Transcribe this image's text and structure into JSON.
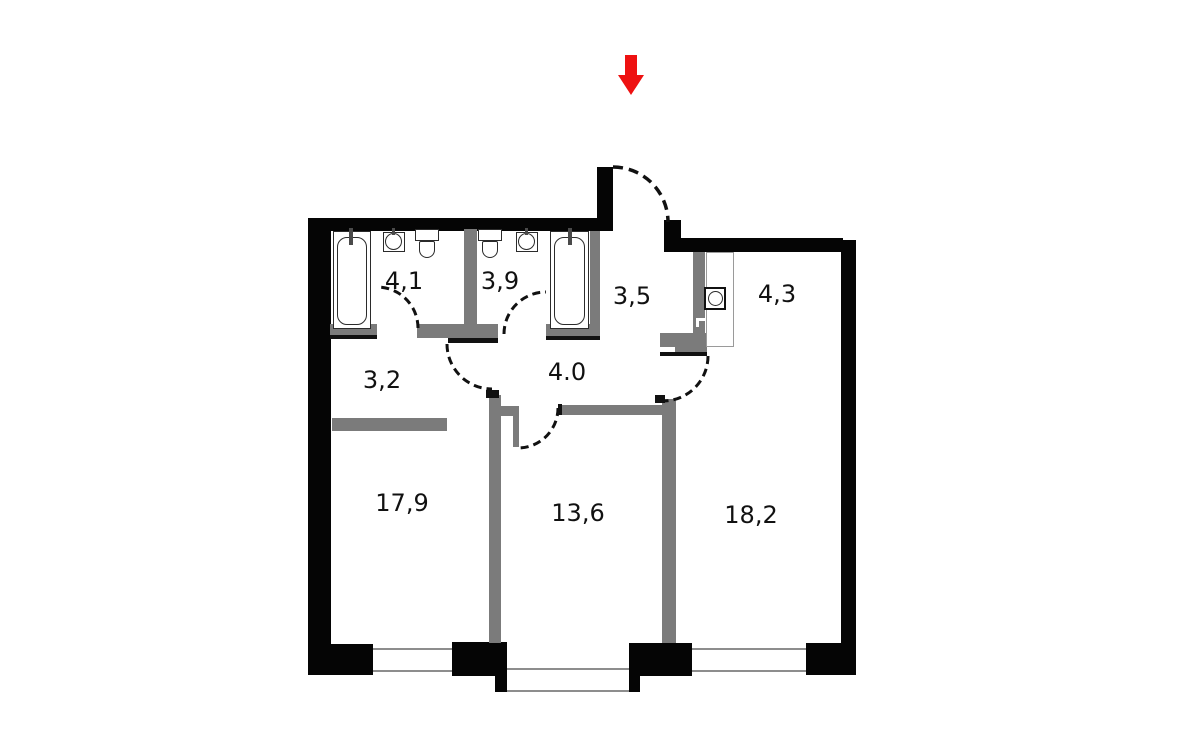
{
  "plan": {
    "type": "apartment-floor-plan",
    "entrance_marker": {
      "shape": "arrow-down",
      "color": "#ee1111"
    },
    "rooms": [
      {
        "name": "bathroom-left",
        "area_label": "4,1"
      },
      {
        "name": "bathroom-right",
        "area_label": "3,9"
      },
      {
        "name": "entry-hall",
        "area_label": "3,5"
      },
      {
        "name": "storage",
        "area_label": "4,3"
      },
      {
        "name": "corridor",
        "area_label": "3,2"
      },
      {
        "name": "inner-hall",
        "area_label": "4.0"
      },
      {
        "name": "living-room",
        "area_label": "17,9"
      },
      {
        "name": "bedroom-middle",
        "area_label": "13,6"
      },
      {
        "name": "bedroom-right",
        "area_label": "18,2"
      }
    ],
    "colors": {
      "exterior_wall": "#050505",
      "interior_wall": "#7b7b7b",
      "window_line": "#8d8d8d",
      "entrance_arrow": "#ee1111",
      "background": "#ffffff"
    }
  }
}
